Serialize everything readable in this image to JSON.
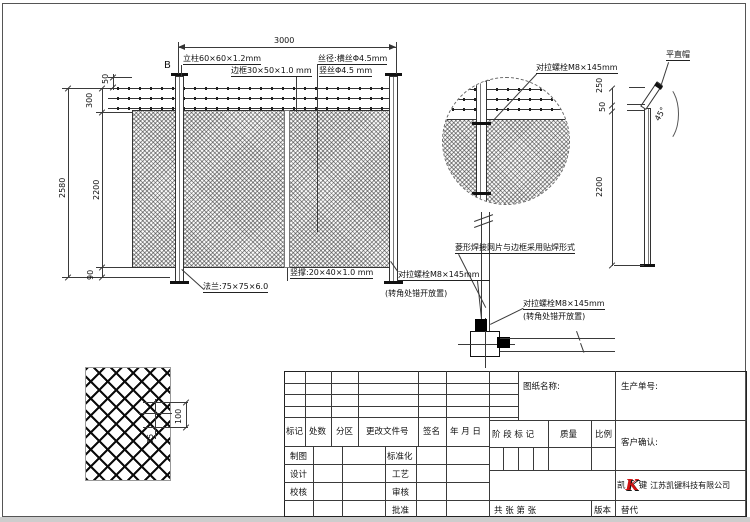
{
  "elevation": {
    "b_marker": "B",
    "dim_span": "3000",
    "dim_total_h": "2580",
    "dim_mesh_h": "2200",
    "dim_top_h": "300",
    "dim_top_gap": "50",
    "dim_bottom": "90",
    "label_post": "立柱60×60×1.2mm",
    "label_frame": "边框30×50×1.0 mm",
    "label_wire_h": "丝径:横丝Φ4.5mm",
    "label_wire_v": "竖丝Φ4.5 mm",
    "label_flange": "法兰:75×75×6.0",
    "label_brace": "竖撑:20×40×1.0 mm"
  },
  "detail_circle": {
    "label_bolt": "对拉螺栓M8×145mm"
  },
  "corner_detail": {
    "label_bolt": "对拉螺栓M8×145mm",
    "label_bolt_note": "(转角处错开放置)",
    "label_weld": "菱形焊接网片与边框采用贴焊形式"
  },
  "post_view": {
    "label_cap": "平直帽",
    "angle": "45°",
    "dim_top": "250",
    "dim_gap": "50",
    "dim_height": "2200"
  },
  "mesh_detail": {
    "dim_v": "100",
    "dim_h": "55"
  },
  "titleblock": {
    "headers": [
      "标记",
      "处数",
      "分区",
      "更改文件号",
      "签名",
      "年 月 日"
    ],
    "col1": [
      "制图",
      "设计",
      "校核"
    ],
    "col2": [
      "标准化",
      "工艺",
      "审核",
      "批准"
    ],
    "drawing_name": "图纸名称:",
    "production_no": "生产单号:",
    "stage": "阶 段 标 记",
    "weight": "质量",
    "scale": "比例",
    "customer": "客户确认:",
    "sheets": "共  张  第  张",
    "version": "版本",
    "replace": "替代",
    "company": {
      "prefix": "凯",
      "k": "K",
      "suffix": "键",
      "name": "江苏凯键科技有限公司"
    }
  }
}
